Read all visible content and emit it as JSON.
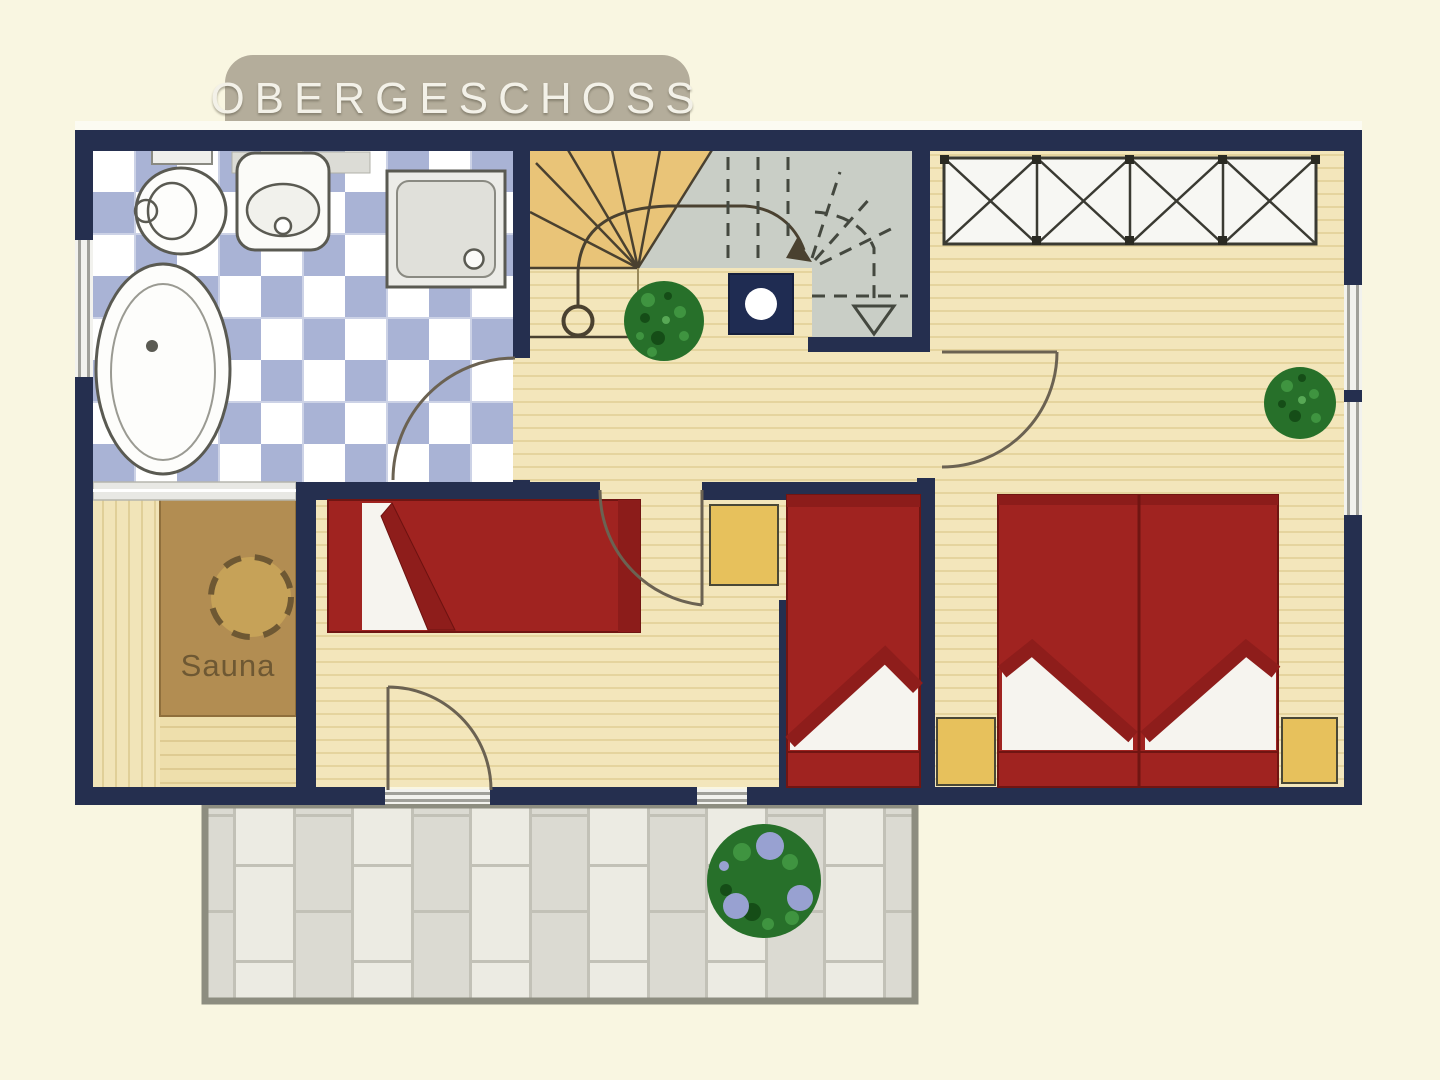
{
  "banner": {
    "title": "OBERGESCHOSS"
  },
  "rooms": {
    "sauna": {
      "label": "Sauna"
    }
  },
  "palette": {
    "wall_navy": "#252f4f",
    "background_cream": "#f9f6e1",
    "wood_floor_tan": "#f3e6bb",
    "bath_tile_blue": "#a9b3d5",
    "stair_lower_yellow": "#e9c478",
    "stair_upper_gray": "#c9cec6",
    "bed_red": "#a02320",
    "bed_fold_dark_red": "#8e1d1b",
    "cabinet_yellow": "#e7c15c",
    "sauna_cabin_brown": "#b28d52",
    "terrace_tile_light": "#ecebe3",
    "terrace_tile_gray": "#dbdad2",
    "plant_green": "#27702a",
    "terrace_berry_blue": "#98a1d1",
    "banner_taupe": "#b4ad9b"
  }
}
